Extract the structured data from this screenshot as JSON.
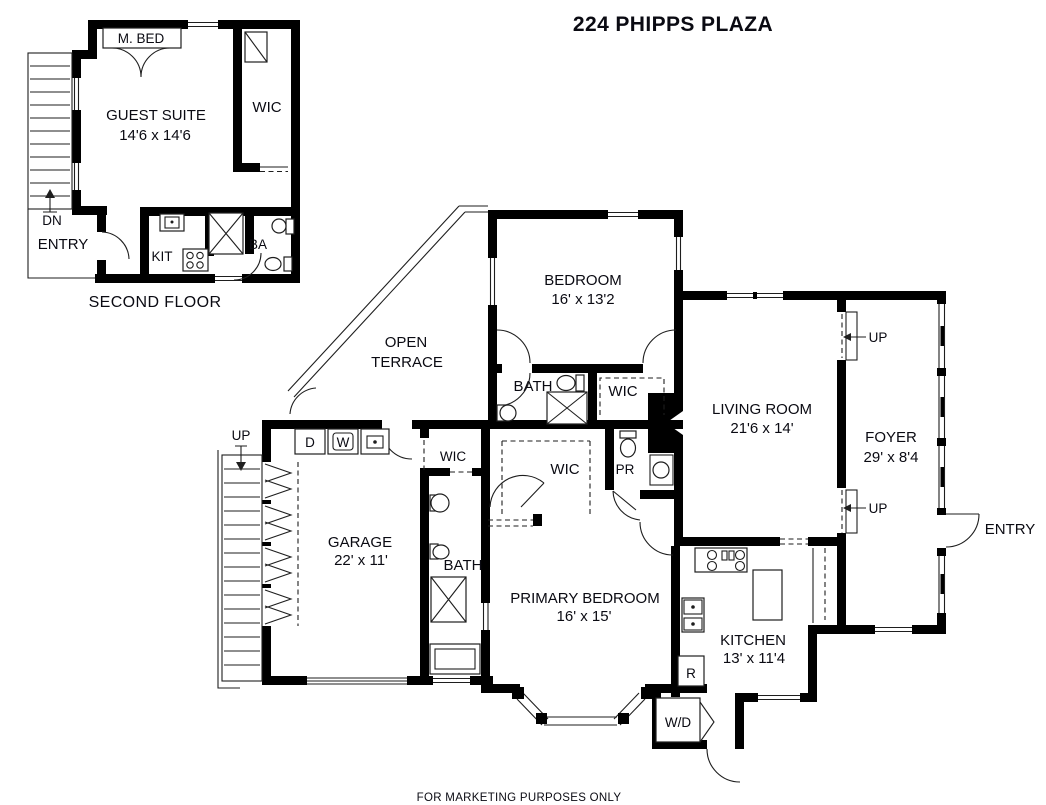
{
  "title": "224 PHIPPS PLAZA",
  "footer": "FOR MARKETING PURPOSES ONLY",
  "colors": {
    "wall": "#000000",
    "line": "#1e1e1e",
    "text": "#0a0a12",
    "background": "#ffffff"
  },
  "second_floor": {
    "caption": "SECOND FLOOR",
    "labels": {
      "m_bed": "M. BED",
      "guest_suite_name": "GUEST SUITE",
      "guest_suite_dims": "14'6 x 14'6",
      "wic": "WIC",
      "dn": "DN",
      "entry": "ENTRY",
      "kit": "KIT",
      "ba": "BA"
    }
  },
  "main_floor": {
    "labels": {
      "terrace_line1": "OPEN",
      "terrace_line2": "TERRACE",
      "bedroom_name": "BEDROOM",
      "bedroom_dims": "16' x 13'2",
      "bath_upper": "BATH",
      "wic_bedroom": "WIC",
      "living_name": "LIVING ROOM",
      "living_dims": "21'6 x 14'",
      "foyer_name": "FOYER",
      "foyer_dims": "29' x 8'4",
      "up_foyer_top": "UP",
      "up_foyer_bottom": "UP",
      "entry": "ENTRY",
      "up_stairs": "UP",
      "dryer": "D",
      "washer": "W",
      "garage_name": "GARAGE",
      "garage_dims": "22' x 11'",
      "wic_garage": "WIC",
      "wic_hall": "WIC",
      "pr": "PR",
      "bath_lower": "BATH",
      "primary_name": "PRIMARY BEDROOM",
      "primary_dims": "16' x 15'",
      "kitchen_name": "KITCHEN",
      "kitchen_dims": "13' x 11'4",
      "fridge": "R",
      "wd": "W/D"
    }
  }
}
